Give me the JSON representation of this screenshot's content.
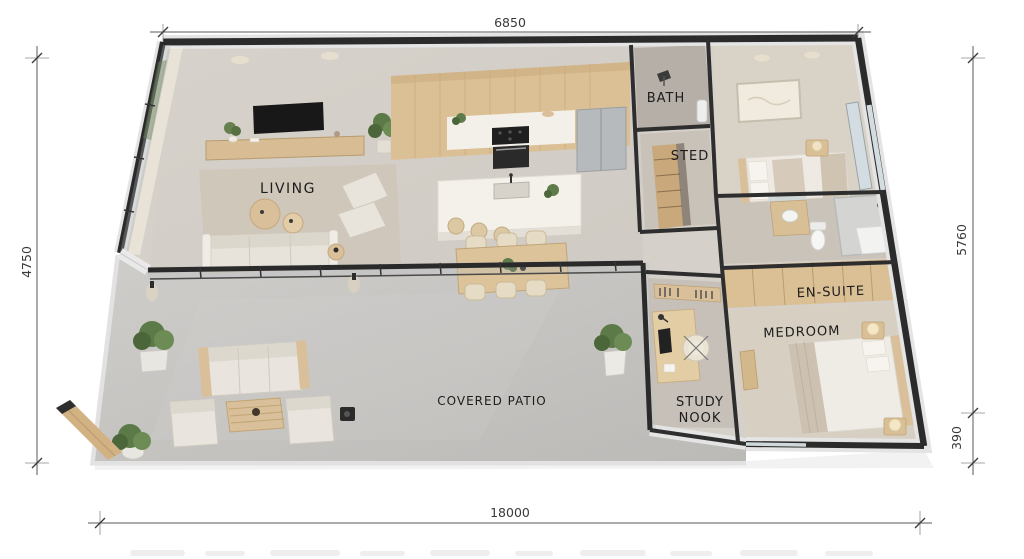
{
  "dimensions": {
    "top": "6850",
    "left": "4750",
    "right": "5760",
    "right_offset": "390",
    "bottom": "18000"
  },
  "rooms": {
    "living": "LIVING",
    "bath": "BATH",
    "sted": "STED",
    "en_suite": "EN-SUITE",
    "bedroom": "MEDROOM",
    "study_line1": "STUDY",
    "study_line2": "NOOK",
    "patio": "COVERED PATIO"
  },
  "colors": {
    "wall": "#2b2b2b",
    "wall_light": "#e4e4e4",
    "floor": "#d5d0c9",
    "patio_floor": "#c7c5c2",
    "timber": "#dbc096",
    "carpet": "#d9d2c6",
    "glass": "#b8c0c3",
    "plant": "#5d7c4a",
    "label": "#1d1d1d",
    "background": "#ffffff"
  }
}
